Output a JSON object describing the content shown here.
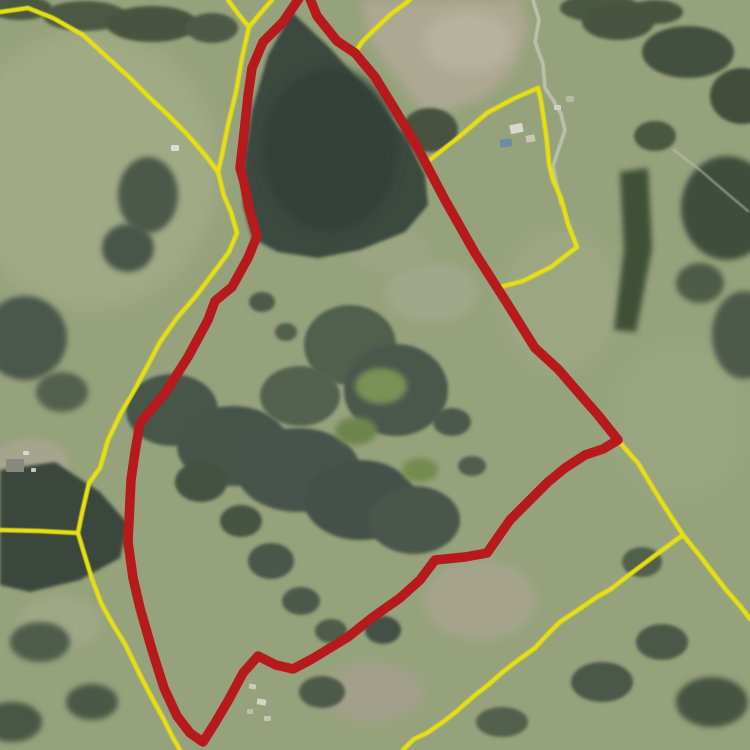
{
  "app": {
    "title": "Aerial cadastral parcel map"
  },
  "map": {
    "width": 750,
    "height": 750,
    "colors": {
      "base_pasture": "#9eaa82",
      "selected_boundary": "#c11216",
      "parcel_boundary": "#f6ee0a",
      "track": "#d0d1c3",
      "forest_dark": "#38463d",
      "dirt_field": "#b8b19a",
      "pool_water": "#6d92b2"
    },
    "selected_parcel": {
      "name": "selected-parcel-boundary",
      "stroke_width": 9.5,
      "points": "302,-6 283,22 263,42 252,68 248,96 243,142 240,168 244,182 249,208 257,236 248,258 232,287 215,301 208,320 188,357 165,393 140,423 135,452 131,480 128,542 133,578 140,608 152,650 164,688 177,716 190,733 203,742 215,723 228,701 243,673 258,656 276,665 293,669 312,659 330,648 348,637 373,617 400,598 420,580 435,560 465,557 487,553 510,520 530,500 548,482 565,468 585,455 603,449 618,440 598,415 584,399 558,369 535,348 505,300 475,253 445,200 415,143 394,108 375,77 355,53 337,41 317,16 308,-6"
    },
    "parcel_lines": [
      {
        "name": "boundary-west-main",
        "points": "0,12 28,8 53,18 83,35 107,57 130,78 150,98 166,113 186,133 206,156 218,172 224,196 231,212 237,233 229,252 214,272 196,296 177,318 160,342 149,363 135,389 121,413 108,440 100,468 89,483 82,513 78,533 84,553 92,579 101,603 112,623 125,644 140,675 152,698 163,718 172,736 180,750"
      },
      {
        "name": "boundary-north-fork-a",
        "points": "228,0 239,15 249,27"
      },
      {
        "name": "boundary-north-fork-b",
        "points": "272,0 259,15 249,27"
      },
      {
        "name": "boundary-north-stem",
        "points": "249,27 242,58 236,92 228,125 222,155 218,172"
      },
      {
        "name": "boundary-apex-east",
        "points": "410,0 391,14 374,30 362,42 355,53"
      },
      {
        "name": "boundary-pool-parcel",
        "points": "427,162 459,137 487,113 513,99 538,88 541,101 544,120 547,142 549,164 553,180 561,198 568,224 577,247 551,267 523,281 500,287"
      },
      {
        "name": "boundary-southeast-spine",
        "points": "618,440 629,453 638,463 650,483 661,501 672,518 683,535"
      },
      {
        "name": "boundary-southeast-right",
        "points": "683,535 700,556 713,573 727,591 741,607 750,619"
      },
      {
        "name": "boundary-southeast-diagonal",
        "points": "683,535 661,551 645,563 629,575 611,589 597,597 575,612 560,622 546,636 535,648 517,661 504,671 488,685 474,696 457,711 443,722 427,733 414,739 403,750"
      },
      {
        "name": "boundary-west-horizontal",
        "points": "0,530 40,531 78,533"
      }
    ],
    "tracks": [
      {
        "name": "farm-track-north",
        "points": "533,0 539,20 535,42 543,64 545,88 553,100 561,114 565,130 559,148 553,166 557,186 561,204",
        "w": 3.5,
        "op": 0.85
      },
      {
        "name": "farm-track-east",
        "points": "674,150 700,170 722,189 748,211",
        "w": 2.5,
        "op": 0.5
      }
    ],
    "buildings": [
      {
        "n": "farmhouse-ne",
        "x": 510,
        "y": 124,
        "w": 13,
        "h": 9,
        "f": "#e9e7dc",
        "rot": -12
      },
      {
        "n": "shed-ne",
        "x": 526,
        "y": 135,
        "w": 9,
        "h": 7,
        "f": "#d7d3c4",
        "rot": -12
      },
      {
        "n": "pool-ne",
        "x": 500,
        "y": 139,
        "w": 12,
        "h": 8,
        "f": "#6d92b2",
        "rot": -8
      },
      {
        "n": "shed-ne-2",
        "x": 554,
        "y": 105,
        "w": 7,
        "h": 5,
        "f": "#e2dfd2",
        "rot": 0
      },
      {
        "n": "shed-ne-3",
        "x": 566,
        "y": 96,
        "w": 8,
        "h": 6,
        "f": "#c9c3ae",
        "rot": 0
      },
      {
        "n": "farmhouse-west",
        "x": 6,
        "y": 459,
        "w": 18,
        "h": 13,
        "f": "#8d8e86",
        "rot": 0
      },
      {
        "n": "shed-west-1",
        "x": 23,
        "y": 451,
        "w": 6,
        "h": 4,
        "f": "#e8e8de",
        "rot": 0
      },
      {
        "n": "shed-west-2",
        "x": 31,
        "y": 468,
        "w": 5,
        "h": 4,
        "f": "#d6d6ca",
        "rot": 0
      },
      {
        "n": "shed-mid-north",
        "x": 171,
        "y": 145,
        "w": 8,
        "h": 6,
        "f": "#ecece2",
        "rot": 0
      },
      {
        "n": "shed-south-1",
        "x": 249,
        "y": 684,
        "w": 7,
        "h": 5,
        "f": "#d9d9cd",
        "rot": 10
      },
      {
        "n": "shed-south-2",
        "x": 257,
        "y": 699,
        "w": 9,
        "h": 6,
        "f": "#e4e4d7",
        "rot": 10
      },
      {
        "n": "shed-south-3",
        "x": 247,
        "y": 709,
        "w": 6,
        "h": 5,
        "f": "#c9c9bb",
        "rot": 0
      },
      {
        "n": "shed-south-4",
        "x": 264,
        "y": 716,
        "w": 7,
        "h": 5,
        "f": "#d3d3c5",
        "rot": 0
      }
    ],
    "terrain": [
      {
        "t": "e",
        "n": "pasture-light",
        "c": [
          90,
          170
        ],
        "r": [
          130,
          140
        ],
        "f": "#a9b38b",
        "blur": "b8"
      },
      {
        "t": "e",
        "n": "pasture-light",
        "c": [
          560,
          300
        ],
        "r": [
          60,
          72
        ],
        "f": "#a4b089",
        "blur": "b8"
      },
      {
        "t": "e",
        "n": "pasture-light",
        "c": [
          680,
          420
        ],
        "r": [
          72,
          82
        ],
        "f": "#a1ad86",
        "blur": "b8"
      },
      {
        "t": "e",
        "n": "pasture-light",
        "c": [
          60,
          622
        ],
        "r": [
          42,
          26
        ],
        "f": "#a8b18d",
        "blur": "b6"
      },
      {
        "t": "e",
        "n": "dry-grass",
        "c": [
          480,
          600
        ],
        "r": [
          56,
          40
        ],
        "f": "#aeac92",
        "blur": "b6"
      },
      {
        "t": "e",
        "n": "dry-grass",
        "c": [
          372,
          692
        ],
        "r": [
          52,
          30
        ],
        "f": "#aba891",
        "blur": "b6"
      },
      {
        "t": "e",
        "n": "pasture-light",
        "c": [
          432,
          292
        ],
        "r": [
          46,
          30
        ],
        "f": "#a9b190",
        "blur": "b6"
      },
      {
        "t": "e",
        "n": "pasture-light",
        "c": [
          390,
          250
        ],
        "r": [
          40,
          22
        ],
        "f": "#a4ae8a",
        "blur": "b6"
      },
      {
        "t": "e",
        "n": "clearing",
        "c": [
          30,
          463
        ],
        "r": [
          38,
          24
        ],
        "f": "#b1ac95",
        "blur": "b4"
      },
      {
        "t": "p",
        "n": "dirt-field",
        "d": "M362,0L520,0 528,30 515,68 488,95 430,118 394,74 370,40Z",
        "f": "#b8b19a",
        "blur": "b6"
      },
      {
        "t": "e",
        "n": "dirt-field",
        "c": [
          468,
          42
        ],
        "r": [
          44,
          30
        ],
        "f": "#c3bca5",
        "blur": "b6"
      },
      {
        "t": "p",
        "n": "forest-north",
        "d": "M292,12L330,48 372,95 408,140 425,175 428,205 405,232 360,250 318,258 278,252 252,238 243,205 244,160 252,110 268,55Z",
        "f": "#38463d",
        "blur": "b2"
      },
      {
        "t": "e",
        "n": "forest-north-core",
        "c": [
          330,
          150
        ],
        "r": [
          68,
          82
        ],
        "f": "#2e3c34",
        "blur": "b6"
      },
      {
        "t": "e",
        "n": "tree-clump",
        "c": [
          430,
          130
        ],
        "r": [
          28,
          22
        ],
        "f": "#44513f",
        "blur": "b2"
      },
      {
        "t": "p",
        "n": "forest-west-wedge",
        "d": "M0,470L55,462 100,492 128,524 120,558 80,580 30,592 0,585Z",
        "f": "#37453a",
        "blur": "b2"
      },
      {
        "t": "p",
        "n": "hedge-east",
        "d": "M620,172L648,168 652,248 636,332 614,330 624,250Z",
        "f": "#3d4f35",
        "blur": "b4"
      },
      {
        "t": "e",
        "n": "tree-clump",
        "c": [
          20,
          8
        ],
        "r": [
          32,
          12
        ],
        "f": "#4a5641",
        "blur": "b2"
      },
      {
        "t": "e",
        "n": "tree-clump",
        "c": [
          85,
          16
        ],
        "r": [
          42,
          15
        ],
        "f": "#4c5843",
        "blur": "b2"
      },
      {
        "t": "e",
        "n": "tree-clump",
        "c": [
          152,
          24
        ],
        "r": [
          46,
          18
        ],
        "f": "#47533e",
        "blur": "b2"
      },
      {
        "t": "e",
        "n": "tree-clump",
        "c": [
          212,
          28
        ],
        "r": [
          26,
          15
        ],
        "f": "#4d5944",
        "blur": "b2"
      },
      {
        "t": "e",
        "n": "tree-clump",
        "c": [
          600,
          8
        ],
        "r": [
          40,
          14
        ],
        "f": "#4a5641",
        "blur": "b2"
      },
      {
        "t": "e",
        "n": "tree-clump",
        "c": [
          655,
          12
        ],
        "r": [
          28,
          12
        ],
        "f": "#46523d",
        "blur": "b2"
      },
      {
        "t": "e",
        "n": "tree-clump",
        "c": [
          148,
          195
        ],
        "r": [
          30,
          38
        ],
        "f": "#4b584a",
        "blur": "b4"
      },
      {
        "t": "e",
        "n": "tree-clump",
        "c": [
          128,
          248
        ],
        "r": [
          26,
          24
        ],
        "f": "#46544a",
        "blur": "b4"
      },
      {
        "t": "e",
        "n": "tree-clump",
        "c": [
          25,
          338
        ],
        "r": [
          42,
          42
        ],
        "f": "#4a574b",
        "blur": "b4"
      },
      {
        "t": "e",
        "n": "tree-clump",
        "c": [
          62,
          392
        ],
        "r": [
          26,
          20
        ],
        "f": "#53604d",
        "blur": "b4"
      },
      {
        "t": "e",
        "n": "tree-clump",
        "c": [
          618,
          22
        ],
        "r": [
          36,
          18
        ],
        "f": "#46523e",
        "blur": "b2"
      },
      {
        "t": "e",
        "n": "tree-clump",
        "c": [
          688,
          52
        ],
        "r": [
          46,
          26
        ],
        "f": "#424f3c",
        "blur": "b2"
      },
      {
        "t": "e",
        "n": "tree-clump",
        "c": [
          742,
          96
        ],
        "r": [
          32,
          28
        ],
        "f": "#3f4c39",
        "blur": "b2"
      },
      {
        "t": "e",
        "n": "tree-clump",
        "c": [
          655,
          136
        ],
        "r": [
          21,
          15
        ],
        "f": "#49563f",
        "blur": "b2"
      },
      {
        "t": "e",
        "n": "tree-clump",
        "c": [
          727,
          208
        ],
        "r": [
          46,
          52
        ],
        "f": "#3e4b3a",
        "blur": "b4"
      },
      {
        "t": "e",
        "n": "tree-clump",
        "c": [
          744,
          335
        ],
        "r": [
          32,
          44
        ],
        "f": "#4d5a48",
        "blur": "b4"
      },
      {
        "t": "e",
        "n": "tree-clump",
        "c": [
          700,
          283
        ],
        "r": [
          24,
          20
        ],
        "f": "#4e5b47",
        "blur": "b4"
      },
      {
        "t": "e",
        "n": "bush-band",
        "c": [
          172,
          410
        ],
        "r": [
          46,
          36
        ],
        "f": "#47544a",
        "blur": "b2"
      },
      {
        "t": "e",
        "n": "bush-band",
        "c": [
          233,
          446
        ],
        "r": [
          56,
          40
        ],
        "f": "#45524a",
        "blur": "b2"
      },
      {
        "t": "e",
        "n": "bush-band",
        "c": [
          298,
          470
        ],
        "r": [
          62,
          42
        ],
        "f": "#46534b",
        "blur": "b2"
      },
      {
        "t": "e",
        "n": "bush-band",
        "c": [
          360,
          500
        ],
        "r": [
          56,
          40
        ],
        "f": "#43504a",
        "blur": "b2"
      },
      {
        "t": "e",
        "n": "bush-band",
        "c": [
          414,
          520
        ],
        "r": [
          46,
          34
        ],
        "f": "#48554c",
        "blur": "b2"
      },
      {
        "t": "e",
        "n": "bush-band",
        "c": [
          350,
          345
        ],
        "r": [
          46,
          40
        ],
        "f": "#515e4d",
        "blur": "b2"
      },
      {
        "t": "e",
        "n": "bush-band",
        "c": [
          396,
          390
        ],
        "r": [
          52,
          46
        ],
        "f": "#4a574b",
        "blur": "b2"
      },
      {
        "t": "e",
        "n": "bush-band",
        "c": [
          300,
          396
        ],
        "r": [
          40,
          30
        ],
        "f": "#55624f",
        "blur": "b2"
      },
      {
        "t": "e",
        "n": "tree-dot",
        "c": [
          262,
          302
        ],
        "r": [
          13,
          10
        ],
        "f": "#4d5a48",
        "blur": "b2"
      },
      {
        "t": "e",
        "n": "tree-dot",
        "c": [
          286,
          332
        ],
        "r": [
          11,
          9
        ],
        "f": "#51604c",
        "blur": "b2"
      },
      {
        "t": "e",
        "n": "tree-dot",
        "c": [
          452,
          422
        ],
        "r": [
          19,
          14
        ],
        "f": "#4b584c",
        "blur": "b2"
      },
      {
        "t": "e",
        "n": "tree-dot",
        "c": [
          472,
          466
        ],
        "r": [
          14,
          10
        ],
        "f": "#505d4d",
        "blur": "b2"
      },
      {
        "t": "e",
        "n": "tree-dot",
        "c": [
          201,
          482
        ],
        "r": [
          26,
          20
        ],
        "f": "#42503f",
        "blur": "b2"
      },
      {
        "t": "e",
        "n": "tree-dot",
        "c": [
          241,
          521
        ],
        "r": [
          21,
          16
        ],
        "f": "#45523f",
        "blur": "b2"
      },
      {
        "t": "e",
        "n": "tree-dot",
        "c": [
          271,
          561
        ],
        "r": [
          23,
          18
        ],
        "f": "#48554a",
        "blur": "b2"
      },
      {
        "t": "e",
        "n": "tree-dot",
        "c": [
          301,
          601
        ],
        "r": [
          19,
          14
        ],
        "f": "#4b5848",
        "blur": "b2"
      },
      {
        "t": "e",
        "n": "tree-dot",
        "c": [
          331,
          631
        ],
        "r": [
          16,
          12
        ],
        "f": "#4e5b49",
        "blur": "b2"
      },
      {
        "t": "e",
        "n": "tree-dot",
        "c": [
          383,
          630
        ],
        "r": [
          18,
          14
        ],
        "f": "#404f44",
        "blur": "b2"
      },
      {
        "t": "e",
        "n": "bright-grass",
        "c": [
          381,
          386
        ],
        "r": [
          26,
          18
        ],
        "f": "#7d9757",
        "blur": "b4"
      },
      {
        "t": "e",
        "n": "bright-grass",
        "c": [
          356,
          431
        ],
        "r": [
          21,
          14
        ],
        "f": "#6f8a4e",
        "blur": "b4"
      },
      {
        "t": "e",
        "n": "bright-grass",
        "c": [
          420,
          470
        ],
        "r": [
          18,
          12
        ],
        "f": "#78914f",
        "blur": "b4"
      },
      {
        "t": "e",
        "n": "tree-clump",
        "c": [
          40,
          642
        ],
        "r": [
          30,
          20
        ],
        "f": "#4e5b49",
        "blur": "b4"
      },
      {
        "t": "e",
        "n": "tree-clump",
        "c": [
          92,
          702
        ],
        "r": [
          26,
          18
        ],
        "f": "#4a5745",
        "blur": "b4"
      },
      {
        "t": "e",
        "n": "tree-clump",
        "c": [
          12,
          722
        ],
        "r": [
          30,
          20
        ],
        "f": "#475442",
        "blur": "b4"
      },
      {
        "t": "e",
        "n": "tree-dot",
        "c": [
          322,
          692
        ],
        "r": [
          23,
          16
        ],
        "f": "#4d5a48",
        "blur": "b2"
      },
      {
        "t": "e",
        "n": "tree-dot",
        "c": [
          502,
          722
        ],
        "r": [
          26,
          15
        ],
        "f": "#52604b",
        "blur": "b2"
      },
      {
        "t": "e",
        "n": "tree-dot",
        "c": [
          602,
          682
        ],
        "r": [
          31,
          20
        ],
        "f": "#49564a",
        "blur": "b2"
      },
      {
        "t": "e",
        "n": "tree-dot",
        "c": [
          662,
          642
        ],
        "r": [
          26,
          18
        ],
        "f": "#4c5947",
        "blur": "b2"
      },
      {
        "t": "e",
        "n": "tree-clump",
        "c": [
          712,
          702
        ],
        "r": [
          36,
          25
        ],
        "f": "#45523f",
        "blur": "b4"
      },
      {
        "t": "e",
        "n": "tree-dot",
        "c": [
          642,
          562
        ],
        "r": [
          20,
          15
        ],
        "f": "#50604c",
        "blur": "b2"
      }
    ]
  }
}
